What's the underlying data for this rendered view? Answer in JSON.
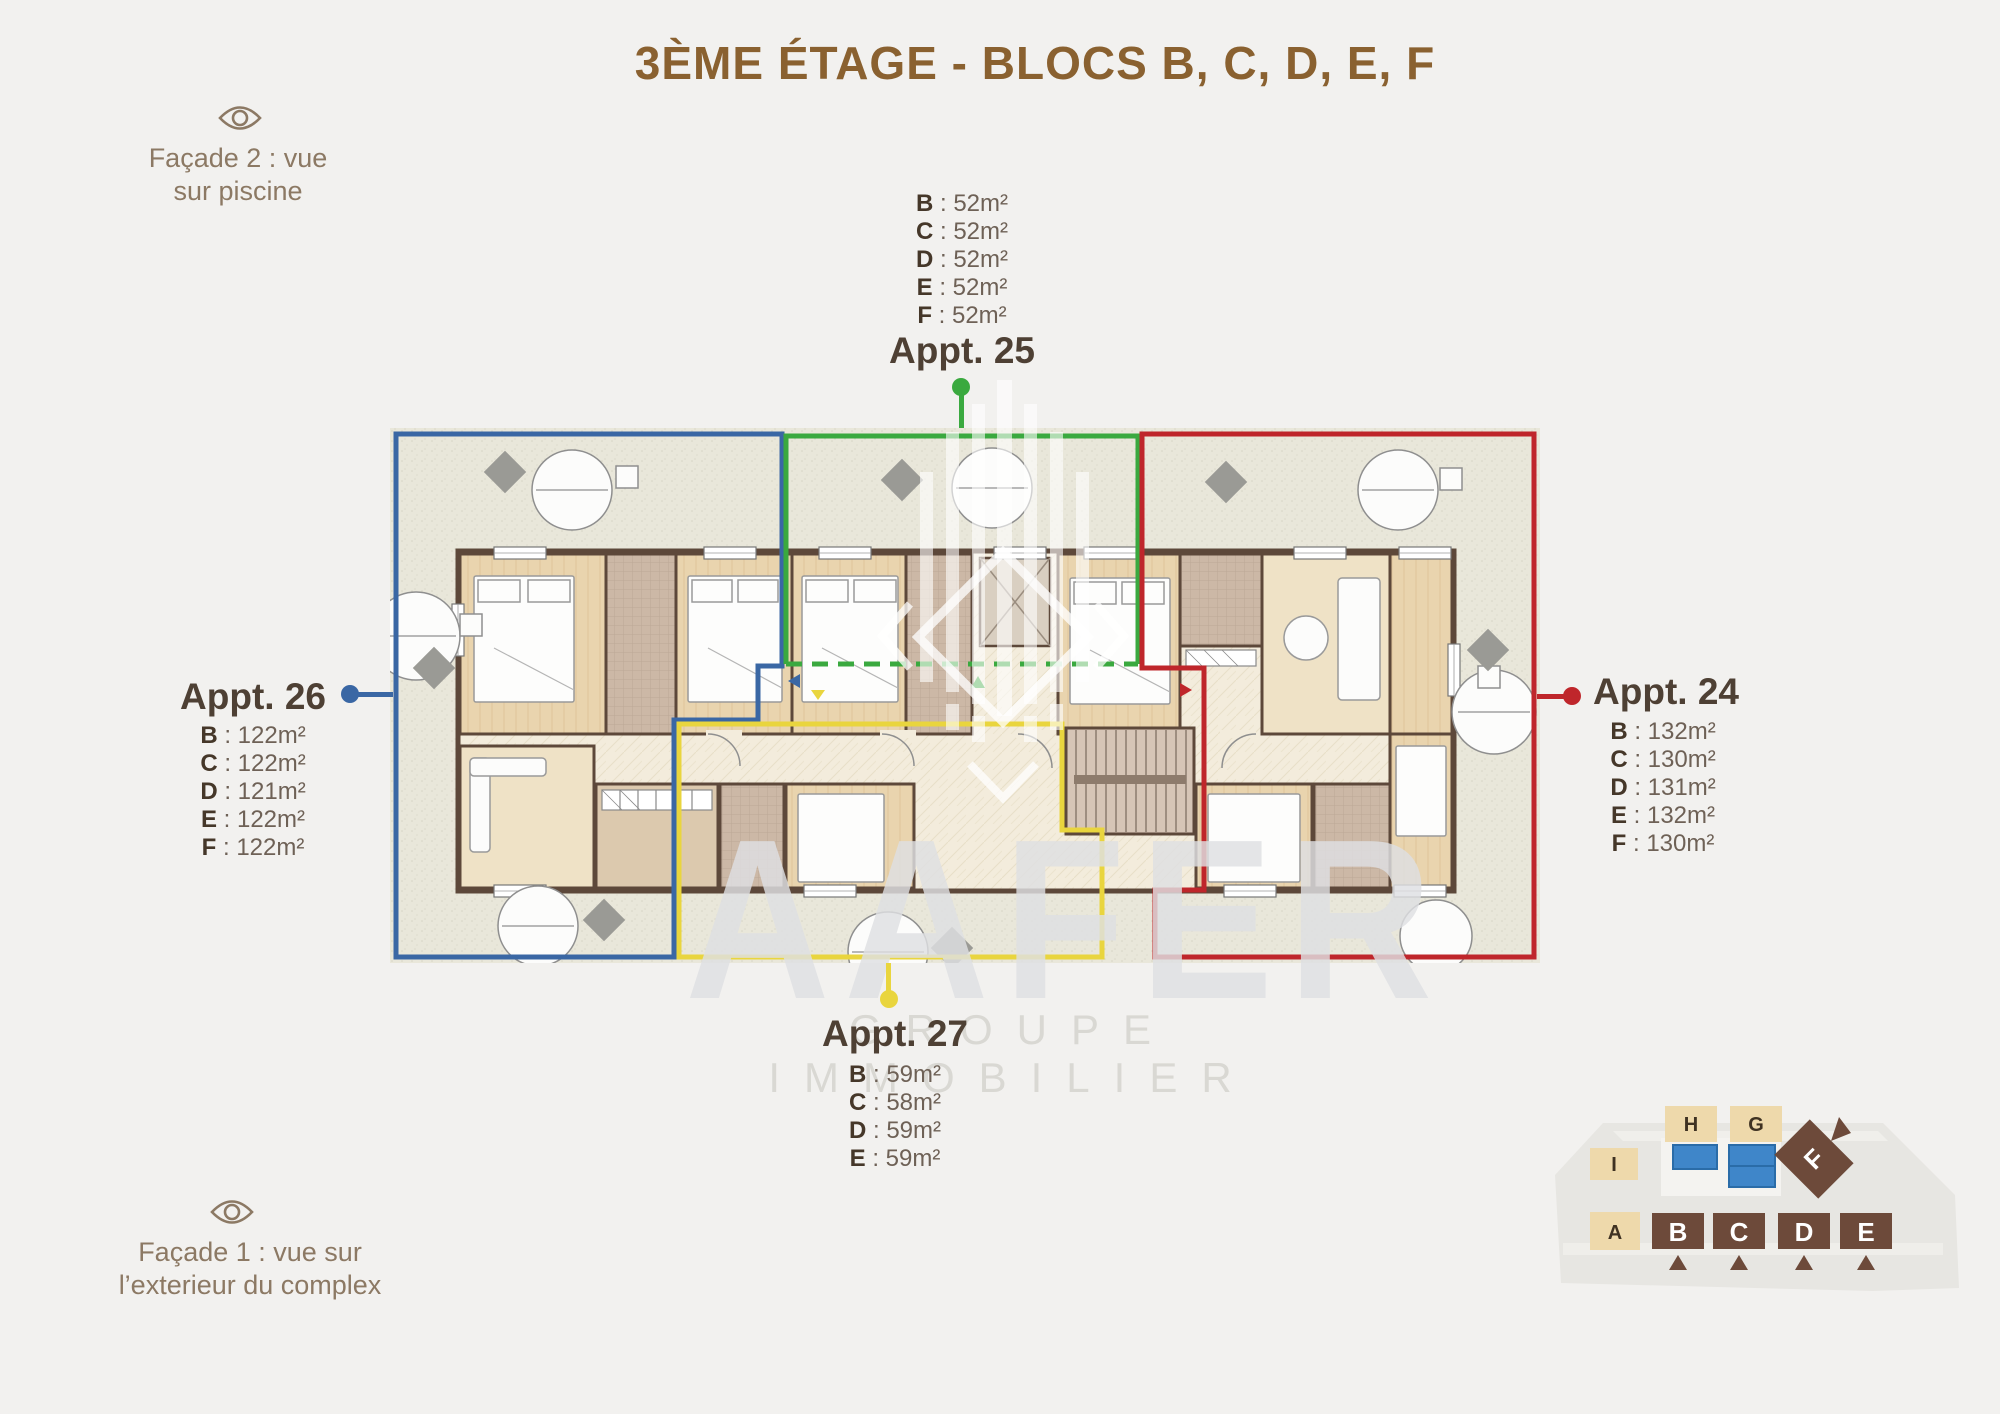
{
  "title": "3ÈME ÉTAGE - BLOCS B, C, D, E, F",
  "facades": {
    "facade2": {
      "line1": "Façade 2 : vue",
      "line2": "sur piscine"
    },
    "facade1": {
      "line1": "Façade 1 : vue sur",
      "line2": "l’exterieur du complex"
    }
  },
  "apartments": {
    "appt25": {
      "label": "Appt. 25",
      "color": "#3aa93f",
      "position": "top",
      "areas": [
        {
          "bloc": "B",
          "area": " : 52m²"
        },
        {
          "bloc": "C",
          "area": " : 52m²"
        },
        {
          "bloc": "D",
          "area": " : 52m²"
        },
        {
          "bloc": "E",
          "area": " : 52m²"
        },
        {
          "bloc": "F",
          "area": " : 52m²"
        }
      ]
    },
    "appt26": {
      "label": "Appt. 26",
      "color": "#3a67a4",
      "position": "left",
      "areas": [
        {
          "bloc": "B",
          "area": " : 122m²"
        },
        {
          "bloc": "C",
          "area": " : 122m²"
        },
        {
          "bloc": "D",
          "area": " : 121m²"
        },
        {
          "bloc": "E",
          "area": " : 122m²"
        },
        {
          "bloc": "F",
          "area": " : 122m²"
        }
      ]
    },
    "appt24": {
      "label": "Appt. 24",
      "color": "#bf262b",
      "position": "right",
      "areas": [
        {
          "bloc": "B",
          "area": " : 132m²"
        },
        {
          "bloc": "C",
          "area": " : 130m²"
        },
        {
          "bloc": "D",
          "area": " : 131m²"
        },
        {
          "bloc": "E",
          "area": " : 132m²"
        },
        {
          "bloc": "F",
          "area": " : 130m²"
        }
      ]
    },
    "appt27": {
      "label": "Appt. 27",
      "color": "#e9d53e",
      "position": "bottom",
      "areas": [
        {
          "bloc": "B",
          "area": " : 59m²"
        },
        {
          "bloc": "C",
          "area": " : 58m²"
        },
        {
          "bloc": "D",
          "area": " : 59m²"
        },
        {
          "bloc": "E",
          "area": " : 59m²"
        }
      ]
    }
  },
  "watermark": {
    "name": "AAFER",
    "subtitle": "GROUPE IMMOBILIER"
  },
  "site_map": {
    "blocks": {
      "h": "H",
      "g": "G",
      "i": "I",
      "f": "F",
      "a": "A",
      "b": "B",
      "c": "C",
      "d": "D",
      "e": "E"
    }
  },
  "colors": {
    "accent_blue": "#3a67a4",
    "accent_green": "#3aa93f",
    "accent_red": "#bf262b",
    "accent_yellow": "#e9d53e",
    "title_brown": "#8a6130",
    "facade_brown": "#8c7964",
    "map_beige": "#eed9ab",
    "map_brown": "#6d4a3a",
    "pool_blue": "#3f86c9"
  }
}
